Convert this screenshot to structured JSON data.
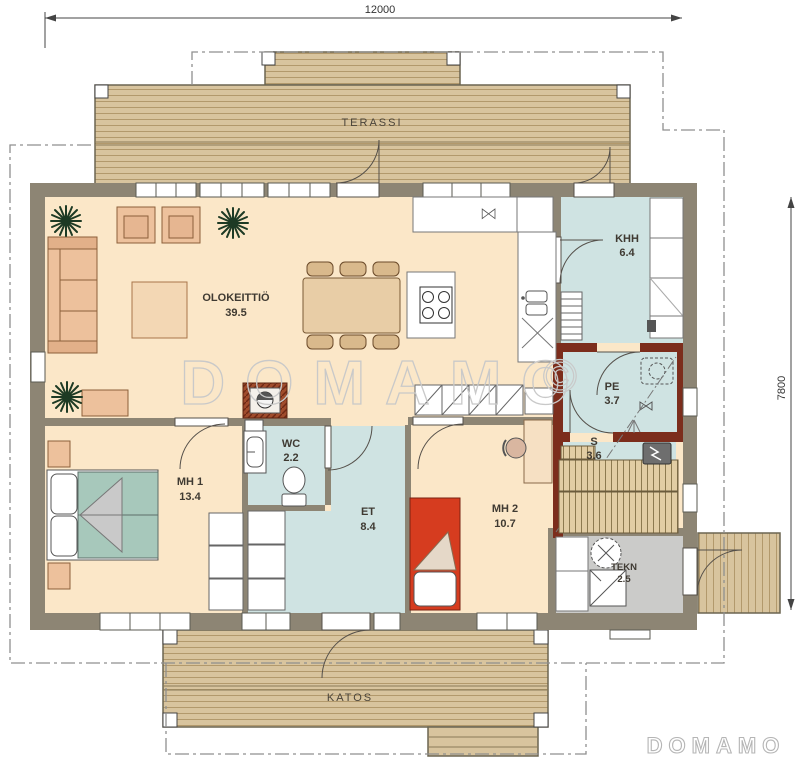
{
  "dimensions": {
    "width_mm": "12000",
    "height_mm": "7800"
  },
  "rooms": {
    "olokeittio": {
      "name": "OLOKEITTIÖ",
      "area": "39.5"
    },
    "khh": {
      "name": "KHH",
      "area": "6.4"
    },
    "pe": {
      "name": "PE",
      "area": "3.7"
    },
    "s": {
      "name": "S",
      "area": "3.6"
    },
    "tekn": {
      "name": "TEKN",
      "area": "2.5"
    },
    "wc": {
      "name": "WC",
      "area": "2.2"
    },
    "et": {
      "name": "ET",
      "area": "8.4"
    },
    "mh1": {
      "name": "MH 1",
      "area": "13.4"
    },
    "mh2": {
      "name": "MH 2",
      "area": "10.7"
    },
    "terassi": {
      "name": "TERASSI"
    },
    "katos": {
      "name": "KATOS"
    }
  },
  "watermark": {
    "text": "DOMAMO",
    "symbol": "©"
  },
  "logo": {
    "text": "DOMAMO"
  },
  "colors": {
    "wall": "#8d8574",
    "wet_wall": "#7c2d1c",
    "floor_cream": "#fbe7c8",
    "floor_wet": "#cfe3e2",
    "floor_tech": "#cbcbc9",
    "deck_wood": "#d8c49e",
    "bed_teal": "#a7c8bb",
    "bed_red": "#d63c1f",
    "furniture_peach": "#edc19c"
  }
}
